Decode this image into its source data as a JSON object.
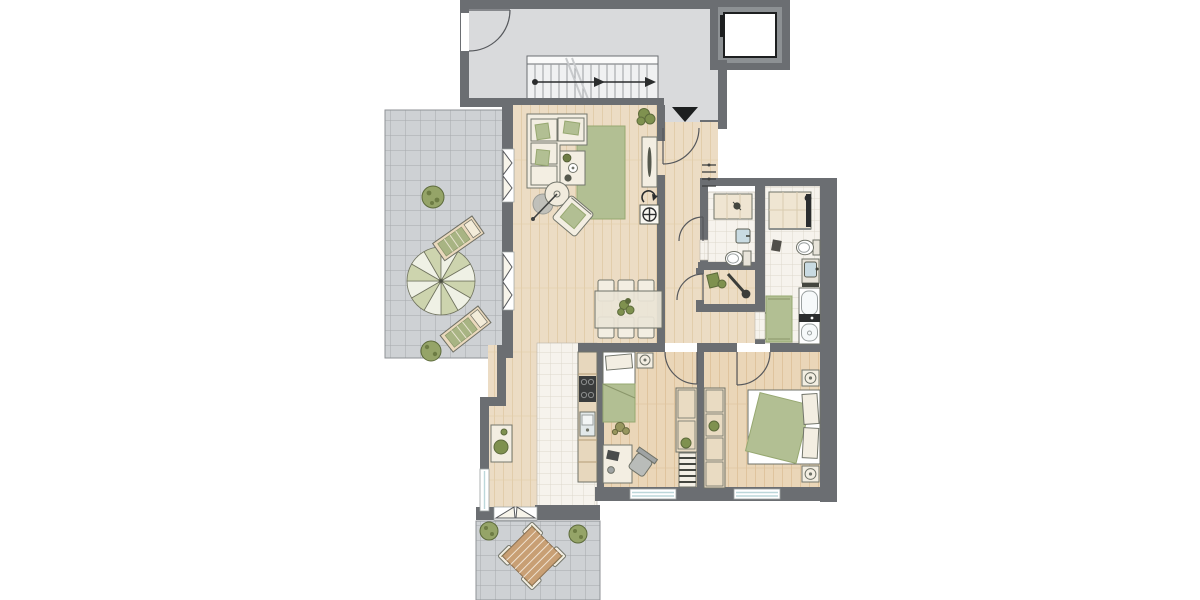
{
  "page": {
    "kind": "architectural-floor-plan",
    "visible_text": "none"
  },
  "colors": {
    "wall": "#6b6e72",
    "corridor": "#d9dadc",
    "stair": "#f0f1f2",
    "stairLine": "#9a9da0",
    "pave": "#ced1d4",
    "paveLine": "#a6a9ac",
    "wood": "#ecdcc4",
    "woodLine": "#e2cdab",
    "woodWarm": "#ead6b8",
    "bathTile": "#f6f3ed",
    "bathTileLine": "#ddd8cd",
    "green": "#b2bf93",
    "greenDark": "#97a871",
    "leaf": "#7f914f",
    "leafDark": "#5d6b3c",
    "cream": "#f3eee2",
    "creamLine": "#73766c",
    "dark": "#2b2d2e",
    "blue": "#bcd7da",
    "fix": "#c9dbe2",
    "counter": "#e7d7bd",
    "tableWood": "#c89f74"
  },
  "rooms": {
    "stairwell": "stairwell with staircase and elevator",
    "terrace": "tiled terrace with parasol and sun loungers",
    "living": "living room with sofa group and rug",
    "dining": "dining area with table for six",
    "kitchen": "open kitchen with counter line",
    "hallway": "entrance hallway",
    "guestWc": "guest wc with shower",
    "storage": "storage room",
    "bathroom": "main bathroom with bathtub and shower",
    "kidsRoom": "children's bedroom with single bed and desk",
    "masterRoom": "master bedroom with double bed",
    "patio": "lower patio with outdoor dining set"
  },
  "symbols": {
    "entranceArrow": "entrance-direction-arrow",
    "stairArrow": "stair-walk-line-arrow",
    "elevator": "elevator-cab",
    "doorArc": "door-swing-arc",
    "frenchDoor": "french-door-opening-triangles",
    "window": "window-glazing-lines",
    "parasol": "parasol-top-view",
    "lounger": "sun-lounger",
    "shrub": "shrub-plant",
    "coatRack": "wall-coat-rack-hooks",
    "electric": "circled-cross-utility-symbol",
    "rotate": "curved-arrow-utility-symbol"
  },
  "counts": {
    "dining_chairs": 6,
    "patio_chairs": 4,
    "sun_loungers": 2,
    "bedrooms": 2,
    "bathrooms": 2,
    "stair_treads": 15,
    "french_doors_terrace": 2
  }
}
